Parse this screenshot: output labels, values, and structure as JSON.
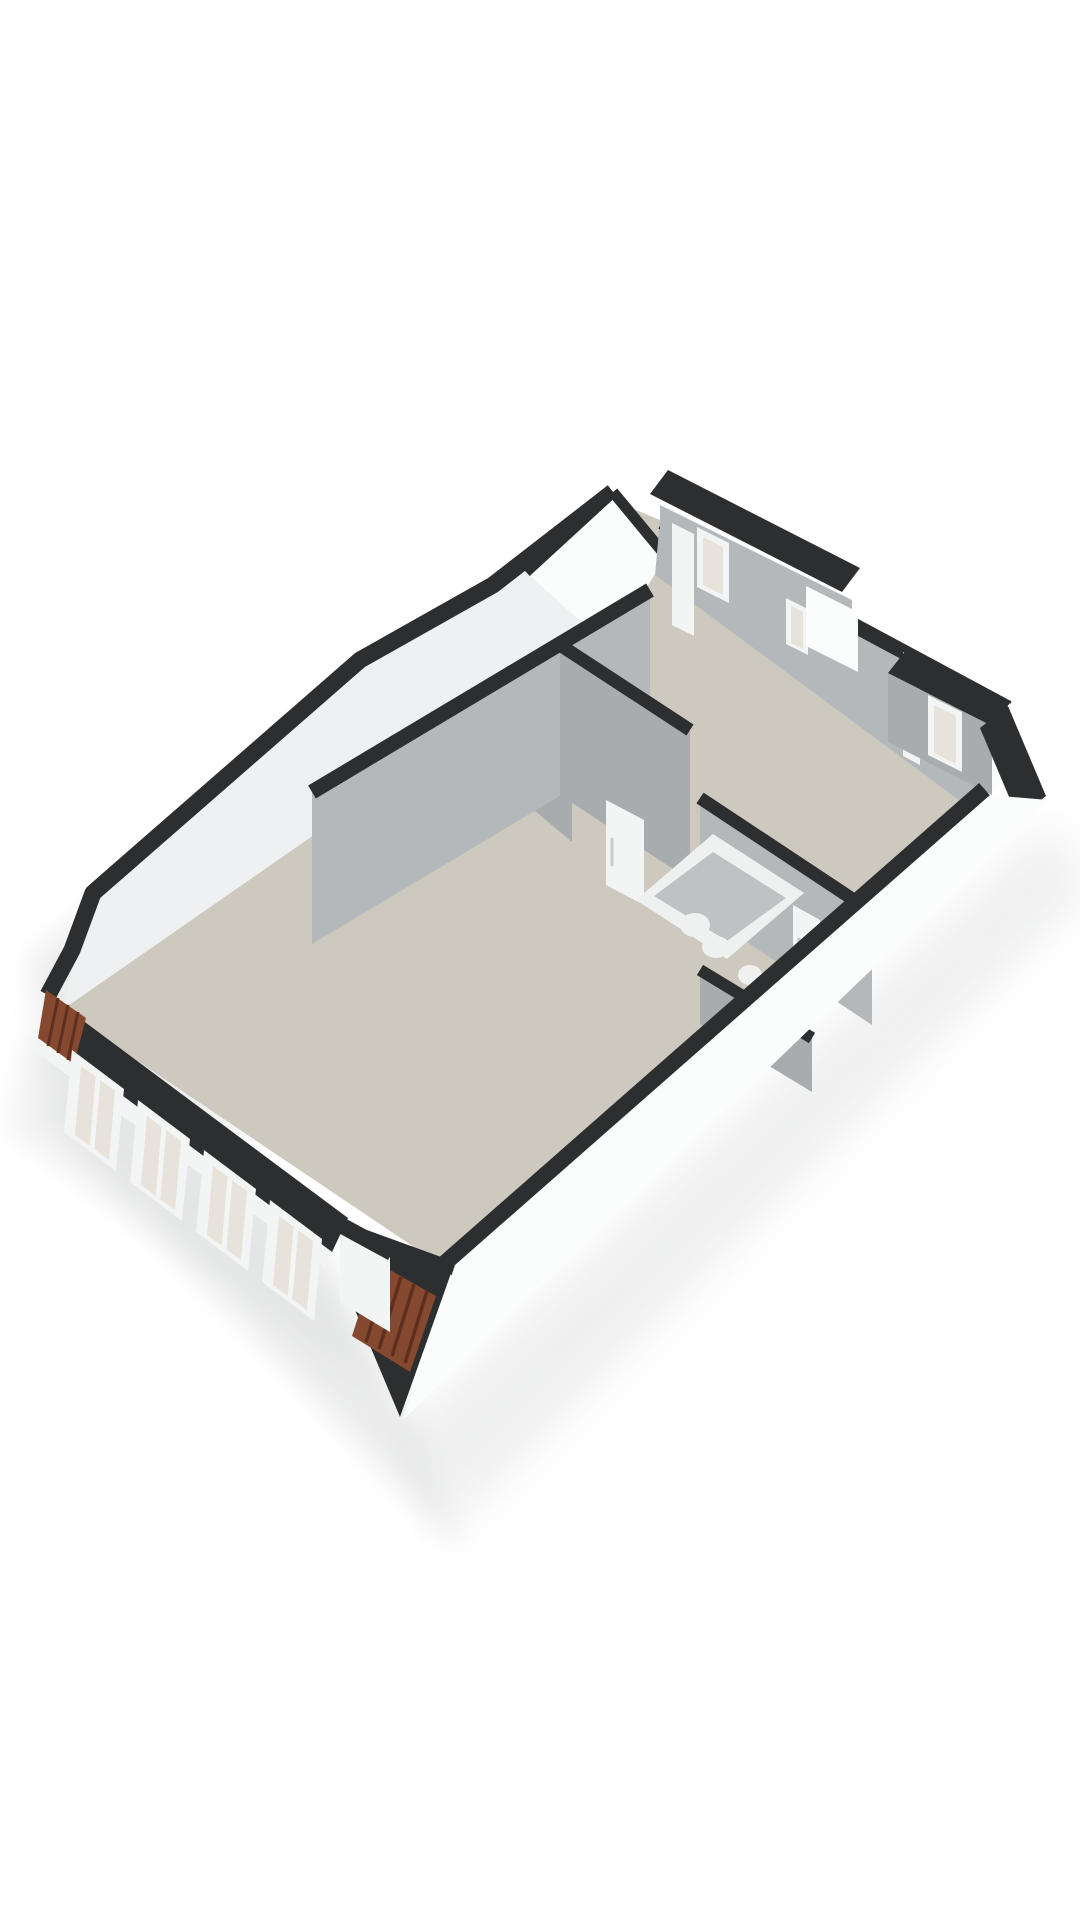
{
  "scene": {
    "type": "3d-floor-plan-render",
    "description": "Isometric 3D cut-away floor plan of a top-floor apartment on a white background. No text labels are rendered in the image.",
    "background": "#ffffff"
  },
  "palette": {
    "wall_top": "#2d2e2f",
    "wall_interior_light": "#eef0f1",
    "wall_interior_gray": "#b5b8ba",
    "wall_interior_gray_dark": "#a9acae",
    "wall_exterior": "#fbfcfc",
    "floor": "#cdc9bf",
    "window_frame": "#f3f4f4",
    "window_glass": "#e7e3da",
    "roof_tile": "#84492f",
    "roof_tile_dark": "#5e2f1e",
    "fixture_white": "#eff0f0",
    "tub_inner": "#bfc2c4",
    "shadow": "#dcdddd"
  },
  "features": {
    "front_wall_windows": 4,
    "dormer_bays": 2,
    "dormer_windows": 3,
    "interior_doors_visible": 2,
    "bathtub": 1,
    "bathroom_fixtures": 3,
    "roof_tile_accents": 2,
    "text_labels": 0
  }
}
